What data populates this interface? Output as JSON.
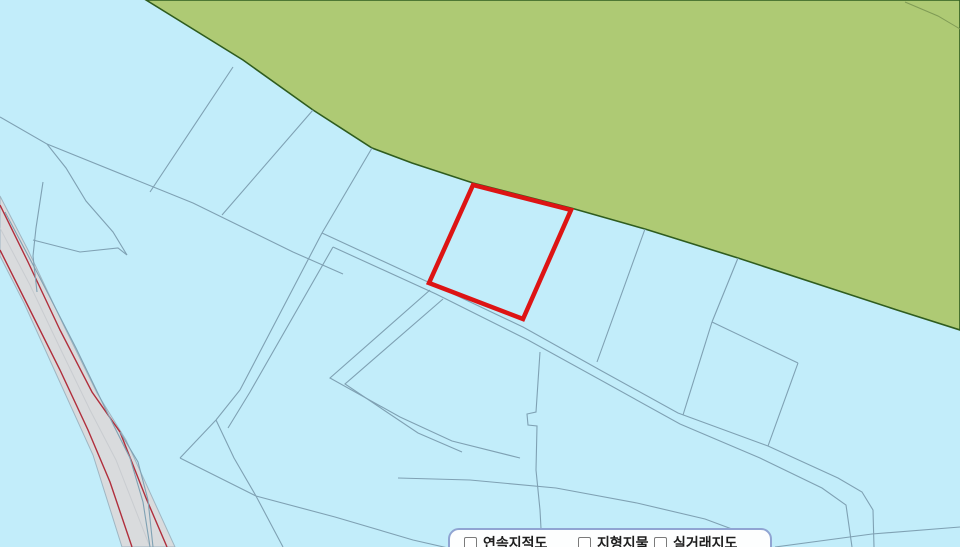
{
  "panel": {
    "items": [
      {
        "label": "연속지적도",
        "checked": false
      },
      {
        "label": "지형지물",
        "checked": false
      },
      {
        "label": "실거래지도",
        "checked": false
      }
    ]
  },
  "map": {
    "width": 960,
    "height": 547,
    "background": "#c2edfa",
    "colors": {
      "parcelLine": "#7fa1b3",
      "parcelLineLight": "#9fb6c2",
      "forestFill": "#aeca74",
      "forestEdge": "#2f5c1e",
      "forestInner": "#7f9b55",
      "roadFill": "#d9dbdd",
      "roadLine": "#b02e3c",
      "roadCenter": "#c9ccd0",
      "selStroke": "#dd1414"
    },
    "features": [
      {
        "name": "forest-area",
        "kind": "polygon",
        "points": "146,0 243,60 313,110 372,148 412,163 473,183 571,208 645,229 738,258 897,310 960,330 960,0",
        "fill": "forestFill",
        "stroke": "forestEdge",
        "width": 1.6,
        "interactable": false
      },
      {
        "name": "forest-inner-line",
        "kind": "polyline",
        "points": "905,2 938,16 955,26 960,29",
        "stroke": "forestInner",
        "width": 1,
        "interactable": false
      },
      {
        "name": "road-area",
        "kind": "polygon",
        "points": "0,196 28,250 64,326 97,393 126,440 175,547 122,547 93,455 58,378 24,303 0,256",
        "fill": "roadFill",
        "stroke": "parcelLineLight",
        "width": 1,
        "interactable": false
      },
      {
        "name": "road-centerline",
        "kind": "polyline",
        "points": "0,228 30,285 60,348 90,410 116,460 150,547",
        "stroke": "roadCenter",
        "width": 1,
        "interactable": false
      },
      {
        "name": "road-edge-left",
        "kind": "polyline",
        "points": "0,250 30,310 60,370 88,430 110,482 132,547",
        "stroke": "roadLine",
        "width": 1.4,
        "interactable": false
      },
      {
        "name": "road-edge-right",
        "kind": "polyline",
        "points": "0,205 28,262 60,330 92,392 120,432 146,498 167,547",
        "stroke": "roadLine",
        "width": 1.4,
        "interactable": false
      },
      {
        "name": "parcel-line-upperleft-curve",
        "kind": "polyline",
        "points": "0,117 47,144 66,168 86,201 113,232 127,255",
        "stroke": "parcelLine",
        "width": 1.1,
        "interactable": false
      },
      {
        "name": "parcel-line-long-diagonal",
        "kind": "polyline",
        "points": "47,144 193,203 293,252 343,274",
        "stroke": "parcelLine",
        "width": 1.1,
        "interactable": false
      },
      {
        "name": "parcel-line-band-1",
        "kind": "polyline",
        "points": "233,67 150,192",
        "stroke": "parcelLine",
        "width": 1.1,
        "interactable": false
      },
      {
        "name": "parcel-line-band-2",
        "kind": "polyline",
        "points": "313,110 222,215",
        "stroke": "parcelLine",
        "width": 1.1,
        "interactable": false
      },
      {
        "name": "parcel-line-band-3",
        "kind": "polyline",
        "points": "372,148 322,233",
        "stroke": "parcelLine",
        "width": 1.1,
        "interactable": false
      },
      {
        "name": "lane-upper-line",
        "kind": "polyline",
        "points": "322,233 428,282 523,327 600,370 678,413 768,446 838,478 862,492 873,510 874,547",
        "stroke": "parcelLine",
        "width": 1.1,
        "interactable": false
      },
      {
        "name": "lane-lower-line",
        "kind": "polyline",
        "points": "333,247 436,294 528,340 606,383 680,424 760,458 822,488 846,505 852,547",
        "stroke": "parcelLine",
        "width": 1.1,
        "interactable": false
      },
      {
        "name": "crosslane-line-1",
        "kind": "polyline",
        "points": "322,233 240,390 216,420",
        "stroke": "parcelLine",
        "width": 1.1,
        "interactable": false
      },
      {
        "name": "crosslane-line-2",
        "kind": "polyline",
        "points": "333,247 250,392 228,428",
        "stroke": "parcelLine",
        "width": 1.1,
        "interactable": false
      },
      {
        "name": "junction-line-1",
        "kind": "polyline",
        "points": "216,420 180,458",
        "stroke": "parcelLine",
        "width": 1.1,
        "interactable": false
      },
      {
        "name": "junction-line-2",
        "kind": "polyline",
        "points": "180,458 256,496 283,547",
        "stroke": "parcelLine",
        "width": 1.1,
        "interactable": false
      },
      {
        "name": "junction-line-3",
        "kind": "polyline",
        "points": "216,420 234,458 256,496",
        "stroke": "parcelLine",
        "width": 1.1,
        "interactable": false
      },
      {
        "name": "bottom-line-lower",
        "kind": "polyline",
        "points": "256,496 335,517 413,540 470,553",
        "stroke": "parcelLine",
        "width": 1.1,
        "interactable": false
      },
      {
        "name": "divider-with-jog",
        "kind": "polyline",
        "points": "540,352 536,412 527,414 528,425 537,426 536,470 540,510 542,547",
        "stroke": "parcelLine",
        "width": 1.1,
        "interactable": false
      },
      {
        "name": "parallelogram-left",
        "kind": "polyline",
        "points": "712,322 683,415",
        "stroke": "parcelLine",
        "width": 1.1,
        "interactable": false
      },
      {
        "name": "parallelogram-top",
        "kind": "polyline",
        "points": "712,322 798,363",
        "stroke": "parcelLine",
        "width": 1.1,
        "interactable": false
      },
      {
        "name": "parallelogram-right",
        "kind": "polyline",
        "points": "798,363 768,446",
        "stroke": "parcelLine",
        "width": 1.1,
        "interactable": false
      },
      {
        "name": "divider-to-forest-1",
        "kind": "polyline",
        "points": "738,258 712,322",
        "stroke": "parcelLine",
        "width": 1.1,
        "interactable": false
      },
      {
        "name": "divider-to-forest-2",
        "kind": "polyline",
        "points": "645,229 597,362",
        "stroke": "parcelLine",
        "width": 1.1,
        "interactable": false
      },
      {
        "name": "bottom-curve",
        "kind": "polyline",
        "points": "398,478 470,480 556,488 637,503 705,519 748,535 760,547",
        "stroke": "parcelLine",
        "width": 1.1,
        "interactable": false
      },
      {
        "name": "bottom-right-diagonal",
        "kind": "polyline",
        "points": "775,547 872,534 960,527",
        "stroke": "parcelLine",
        "width": 1.1,
        "interactable": false
      },
      {
        "name": "zigzag-line-1",
        "kind": "polyline",
        "points": "430,290 330,378 400,417 452,441 520,458",
        "stroke": "parcelLine",
        "width": 1.1,
        "interactable": false
      },
      {
        "name": "zigzag-line-2",
        "kind": "polyline",
        "points": "443,299 345,384 418,433 462,452",
        "stroke": "parcelLine",
        "width": 1.1,
        "interactable": false
      },
      {
        "name": "roadside-line-1",
        "kind": "polyline",
        "points": "43,182 36,228 33,256 37,292",
        "stroke": "parcelLine",
        "width": 1.1,
        "interactable": false
      },
      {
        "name": "roadside-line-2",
        "kind": "polyline",
        "points": "33,240 80,252 118,248 127,255",
        "stroke": "parcelLine",
        "width": 1.1,
        "interactable": false
      },
      {
        "name": "roadside-strip-1",
        "kind": "polyline",
        "points": "5,212 40,278 76,348 106,410 130,458 143,502 150,547",
        "stroke": "parcelLine",
        "width": 1.1,
        "interactable": false
      },
      {
        "name": "roadside-strip-2",
        "kind": "polyline",
        "points": "120,432 138,462 148,500 153,547",
        "stroke": "parcelLine",
        "width": 1.1,
        "interactable": false
      },
      {
        "name": "selected-parcel",
        "kind": "polygon",
        "points": "473,185 571,210 523,319 429,283",
        "fill": "none",
        "stroke": "selStroke",
        "width": 4.5,
        "interactable": true
      }
    ]
  }
}
